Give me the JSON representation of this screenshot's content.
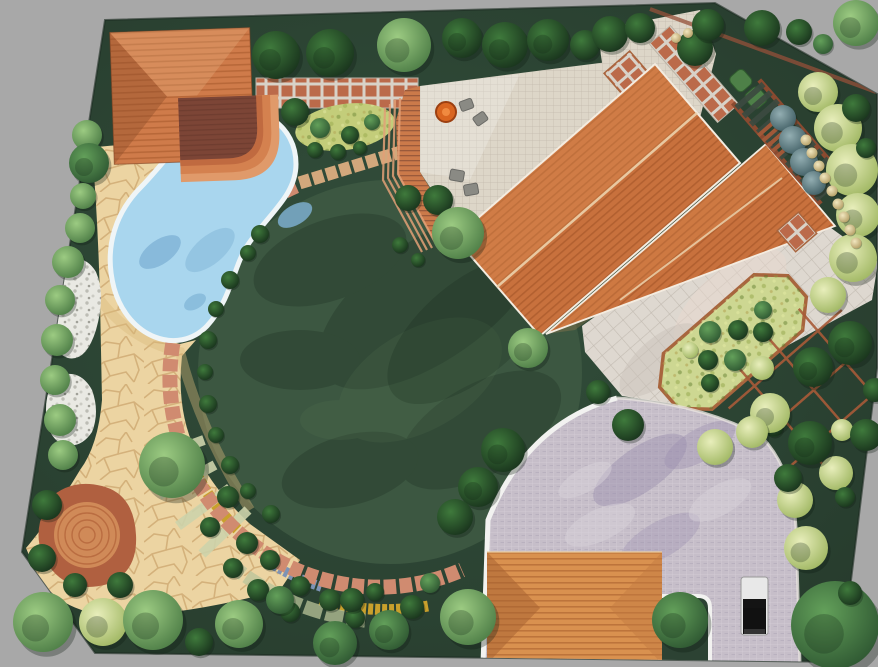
{
  "meta": {
    "scene": "garden-landscape-design-plan",
    "view": "top-down-3d-render",
    "canvas": {
      "width": 878,
      "height": 667
    }
  },
  "palette": {
    "background": "#a8a8a8",
    "ground": "#2c4233",
    "groundLight": "#33503c",
    "groundEdge": "#1d2c22",
    "lawn": "#3c5741",
    "lawnShadow": "#15271a",
    "lawnLight": "#5a7a55",
    "poolWater": "#a9d6ee",
    "poolDeep": "#7fb3d6",
    "poolShallow": "#c9e9f8",
    "coping": "#eff5f7",
    "flagstone": "#ecd4a2",
    "flagLine": "#bd9257",
    "gravel": "#e9e9e3",
    "roof": "#c8713d",
    "roofLine": "#9c4f24",
    "ridge": "#ecd2ac",
    "eave": "#f4ece0",
    "pavilionRoof": "#cf7b4a",
    "deckDark": "#7c4536",
    "deckWood": "#cb7a4a",
    "stepTerracotta": "#d4814f",
    "patioTile": "#ddd6c8",
    "terracePaver": "#ded8d0",
    "brickSquare": "#bb6a4a",
    "grout": "#d8d2c8",
    "paverArc": "#d08b70",
    "driveway": "#c6bec9",
    "driveMottle": "#9a8fae",
    "curb": "#f2f2f0",
    "garageRoof": "#d9914f",
    "carBody": "#e8e8e8",
    "carGlass": "#141414",
    "firePit": "#d96520",
    "cushion": "#8a8a84",
    "goldFlower": "#c9a02c",
    "blueFlower": "#7d93b5",
    "stepBand": "#cdd3ab",
    "paleBand": "#b9c49a",
    "herbBed": "#cdd792",
    "yellowBed": "#c3cd7a",
    "brickEdge": "#a8653e",
    "pergolaSlat": "#3c4a40",
    "pergolaRail": "#8a4a30",
    "hedge": "#4e8048",
    "circlePatio": "#d08a58",
    "circlePatioRing": "#b5663c",
    "terraBlob": "#b06040",
    "wallLight": "#cfd4c9",
    "wallBrick": "#94503a"
  },
  "treeTypes": {
    "dark": {
      "inner": "#3f7a3c",
      "outer": "#17301b"
    },
    "medium": {
      "inner": "#63a05a",
      "outer": "#2c5430"
    },
    "light": {
      "inner": "#9ccb82",
      "outer": "#4a7a44"
    },
    "pale": {
      "inner": "#e8eebb",
      "outer": "#9cb45e"
    },
    "blue": {
      "inner": "#93aeb2",
      "outer": "#3c5a60"
    },
    "cream": {
      "inner": "#f2e7c0",
      "outer": "#b09a60"
    }
  },
  "vegetation": {
    "trees": [
      [
        276,
        55,
        24,
        "dark"
      ],
      [
        330,
        53,
        24,
        "dark"
      ],
      [
        404,
        45,
        27,
        "light"
      ],
      [
        462,
        38,
        20,
        "dark"
      ],
      [
        505,
        45,
        23,
        "dark"
      ],
      [
        548,
        40,
        21,
        "dark"
      ],
      [
        585,
        45,
        15,
        "dark"
      ],
      [
        610,
        34,
        18,
        "dark"
      ],
      [
        640,
        28,
        15,
        "dark"
      ],
      [
        695,
        48,
        18,
        "dark"
      ],
      [
        708,
        25,
        16,
        "dark"
      ],
      [
        762,
        28,
        18,
        "dark"
      ],
      [
        799,
        32,
        13,
        "dark"
      ],
      [
        823,
        44,
        10,
        "medium"
      ],
      [
        856,
        23,
        23,
        "light"
      ],
      [
        295,
        112,
        14,
        "dark"
      ],
      [
        87,
        135,
        15,
        "light"
      ],
      [
        89,
        163,
        20,
        "medium"
      ],
      [
        83,
        196,
        13,
        "light"
      ],
      [
        80,
        228,
        15,
        "light"
      ],
      [
        68,
        262,
        16,
        "light"
      ],
      [
        60,
        300,
        15,
        "light"
      ],
      [
        57,
        340,
        16,
        "light"
      ],
      [
        55,
        380,
        15,
        "light"
      ],
      [
        60,
        420,
        16,
        "light"
      ],
      [
        63,
        455,
        15,
        "light"
      ],
      [
        47,
        505,
        15,
        "dark"
      ],
      [
        42,
        558,
        14,
        "dark"
      ],
      [
        75,
        585,
        12,
        "dark"
      ],
      [
        120,
        585,
        13,
        "dark"
      ],
      [
        43,
        622,
        30,
        "light"
      ],
      [
        103,
        622,
        24,
        "pale"
      ],
      [
        153,
        620,
        30,
        "light"
      ],
      [
        199,
        642,
        14,
        "dark"
      ],
      [
        239,
        624,
        24,
        "light"
      ],
      [
        172,
        465,
        33,
        "light"
      ],
      [
        335,
        643,
        22,
        "medium"
      ],
      [
        389,
        630,
        20,
        "medium"
      ],
      [
        468,
        617,
        28,
        "light"
      ],
      [
        352,
        600,
        12,
        "dark"
      ],
      [
        412,
        607,
        12,
        "dark"
      ],
      [
        430,
        583,
        10,
        "medium"
      ],
      [
        280,
        600,
        14,
        "medium"
      ],
      [
        438,
        200,
        15,
        "dark"
      ],
      [
        408,
        198,
        13,
        "dark"
      ],
      [
        400,
        245,
        8,
        "dark"
      ],
      [
        418,
        260,
        7,
        "dark"
      ],
      [
        458,
        233,
        26,
        "light"
      ],
      [
        528,
        348,
        20,
        "light"
      ],
      [
        503,
        450,
        22,
        "dark"
      ],
      [
        478,
        487,
        20,
        "dark"
      ],
      [
        455,
        517,
        18,
        "dark"
      ],
      [
        628,
        425,
        16,
        "dark"
      ],
      [
        598,
        392,
        12,
        "dark"
      ],
      [
        680,
        620,
        28,
        "medium"
      ],
      [
        835,
        625,
        44,
        "medium"
      ],
      [
        715,
        447,
        18,
        "pale"
      ],
      [
        795,
        500,
        18,
        "pale"
      ],
      [
        806,
        548,
        22,
        "pale"
      ],
      [
        836,
        473,
        17,
        "pale"
      ],
      [
        842,
        430,
        11,
        "pale"
      ],
      [
        845,
        497,
        10,
        "dark"
      ],
      [
        850,
        593,
        12,
        "dark"
      ],
      [
        774,
        428,
        9,
        "dark"
      ],
      [
        813,
        367,
        20,
        "dark"
      ],
      [
        850,
        343,
        22,
        "dark"
      ],
      [
        810,
        443,
        22,
        "dark"
      ],
      [
        866,
        435,
        16,
        "dark"
      ],
      [
        875,
        390,
        12,
        "dark"
      ],
      [
        788,
        478,
        14,
        "dark"
      ],
      [
        770,
        413,
        20,
        "pale"
      ],
      [
        752,
        432,
        16,
        "pale"
      ],
      [
        762,
        368,
        12,
        "pale"
      ],
      [
        818,
        92,
        20,
        "pale"
      ],
      [
        838,
        128,
        24,
        "pale"
      ],
      [
        852,
        170,
        26,
        "pale"
      ],
      [
        858,
        215,
        22,
        "pale"
      ],
      [
        853,
        258,
        24,
        "pale"
      ],
      [
        828,
        295,
        18,
        "pale"
      ],
      [
        856,
        108,
        14,
        "dark"
      ],
      [
        866,
        148,
        10,
        "dark"
      ],
      [
        783,
        118,
        13,
        "blue"
      ],
      [
        793,
        140,
        14,
        "blue"
      ],
      [
        804,
        162,
        14,
        "blue"
      ],
      [
        814,
        183,
        12,
        "blue"
      ],
      [
        320,
        128,
        10,
        "medium"
      ],
      [
        350,
        135,
        9,
        "dark"
      ],
      [
        372,
        122,
        8,
        "medium"
      ],
      [
        315,
        150,
        8,
        "dark"
      ],
      [
        338,
        152,
        8,
        "dark"
      ],
      [
        360,
        148,
        7,
        "dark"
      ]
    ],
    "lawn_edge_shrubs": [
      [
        260,
        234,
        9
      ],
      [
        248,
        253,
        8
      ],
      [
        230,
        280,
        9
      ],
      [
        216,
        309,
        8
      ],
      [
        208,
        340,
        9
      ],
      [
        205,
        372,
        8
      ],
      [
        208,
        404,
        9
      ],
      [
        216,
        435,
        8
      ],
      [
        230,
        465,
        9
      ],
      [
        248,
        491,
        8
      ],
      [
        271,
        514,
        9
      ],
      [
        228,
        497,
        11
      ],
      [
        210,
        527,
        10
      ],
      [
        247,
        543,
        11
      ],
      [
        233,
        568,
        10
      ],
      [
        270,
        560,
        10
      ],
      [
        258,
        590,
        11
      ],
      [
        300,
        586,
        10
      ],
      [
        290,
        612,
        10
      ],
      [
        330,
        600,
        11
      ],
      [
        355,
        618,
        10
      ],
      [
        375,
        592,
        9
      ],
      [
        190,
        475,
        10
      ]
    ],
    "bed_shrubs": [
      [
        710,
        332,
        11,
        "medium"
      ],
      [
        738,
        330,
        10,
        "dark"
      ],
      [
        763,
        332,
        10,
        "dark"
      ],
      [
        708,
        360,
        10,
        "dark"
      ],
      [
        735,
        360,
        11,
        "medium"
      ],
      [
        710,
        383,
        9,
        "dark"
      ],
      [
        763,
        310,
        9,
        "medium"
      ],
      [
        690,
        350,
        8,
        "pale"
      ]
    ],
    "cream_balls": [
      [
        806,
        140,
        5.5
      ],
      [
        812,
        153,
        5.5
      ],
      [
        819,
        166,
        5.5
      ],
      [
        825,
        178,
        5.5
      ],
      [
        832,
        191,
        5.5
      ],
      [
        838,
        204,
        5.5
      ],
      [
        844,
        217,
        5.5
      ],
      [
        850,
        230,
        5.5
      ],
      [
        856,
        243,
        5.5
      ],
      [
        676,
        38,
        5
      ],
      [
        688,
        33,
        5
      ]
    ]
  }
}
